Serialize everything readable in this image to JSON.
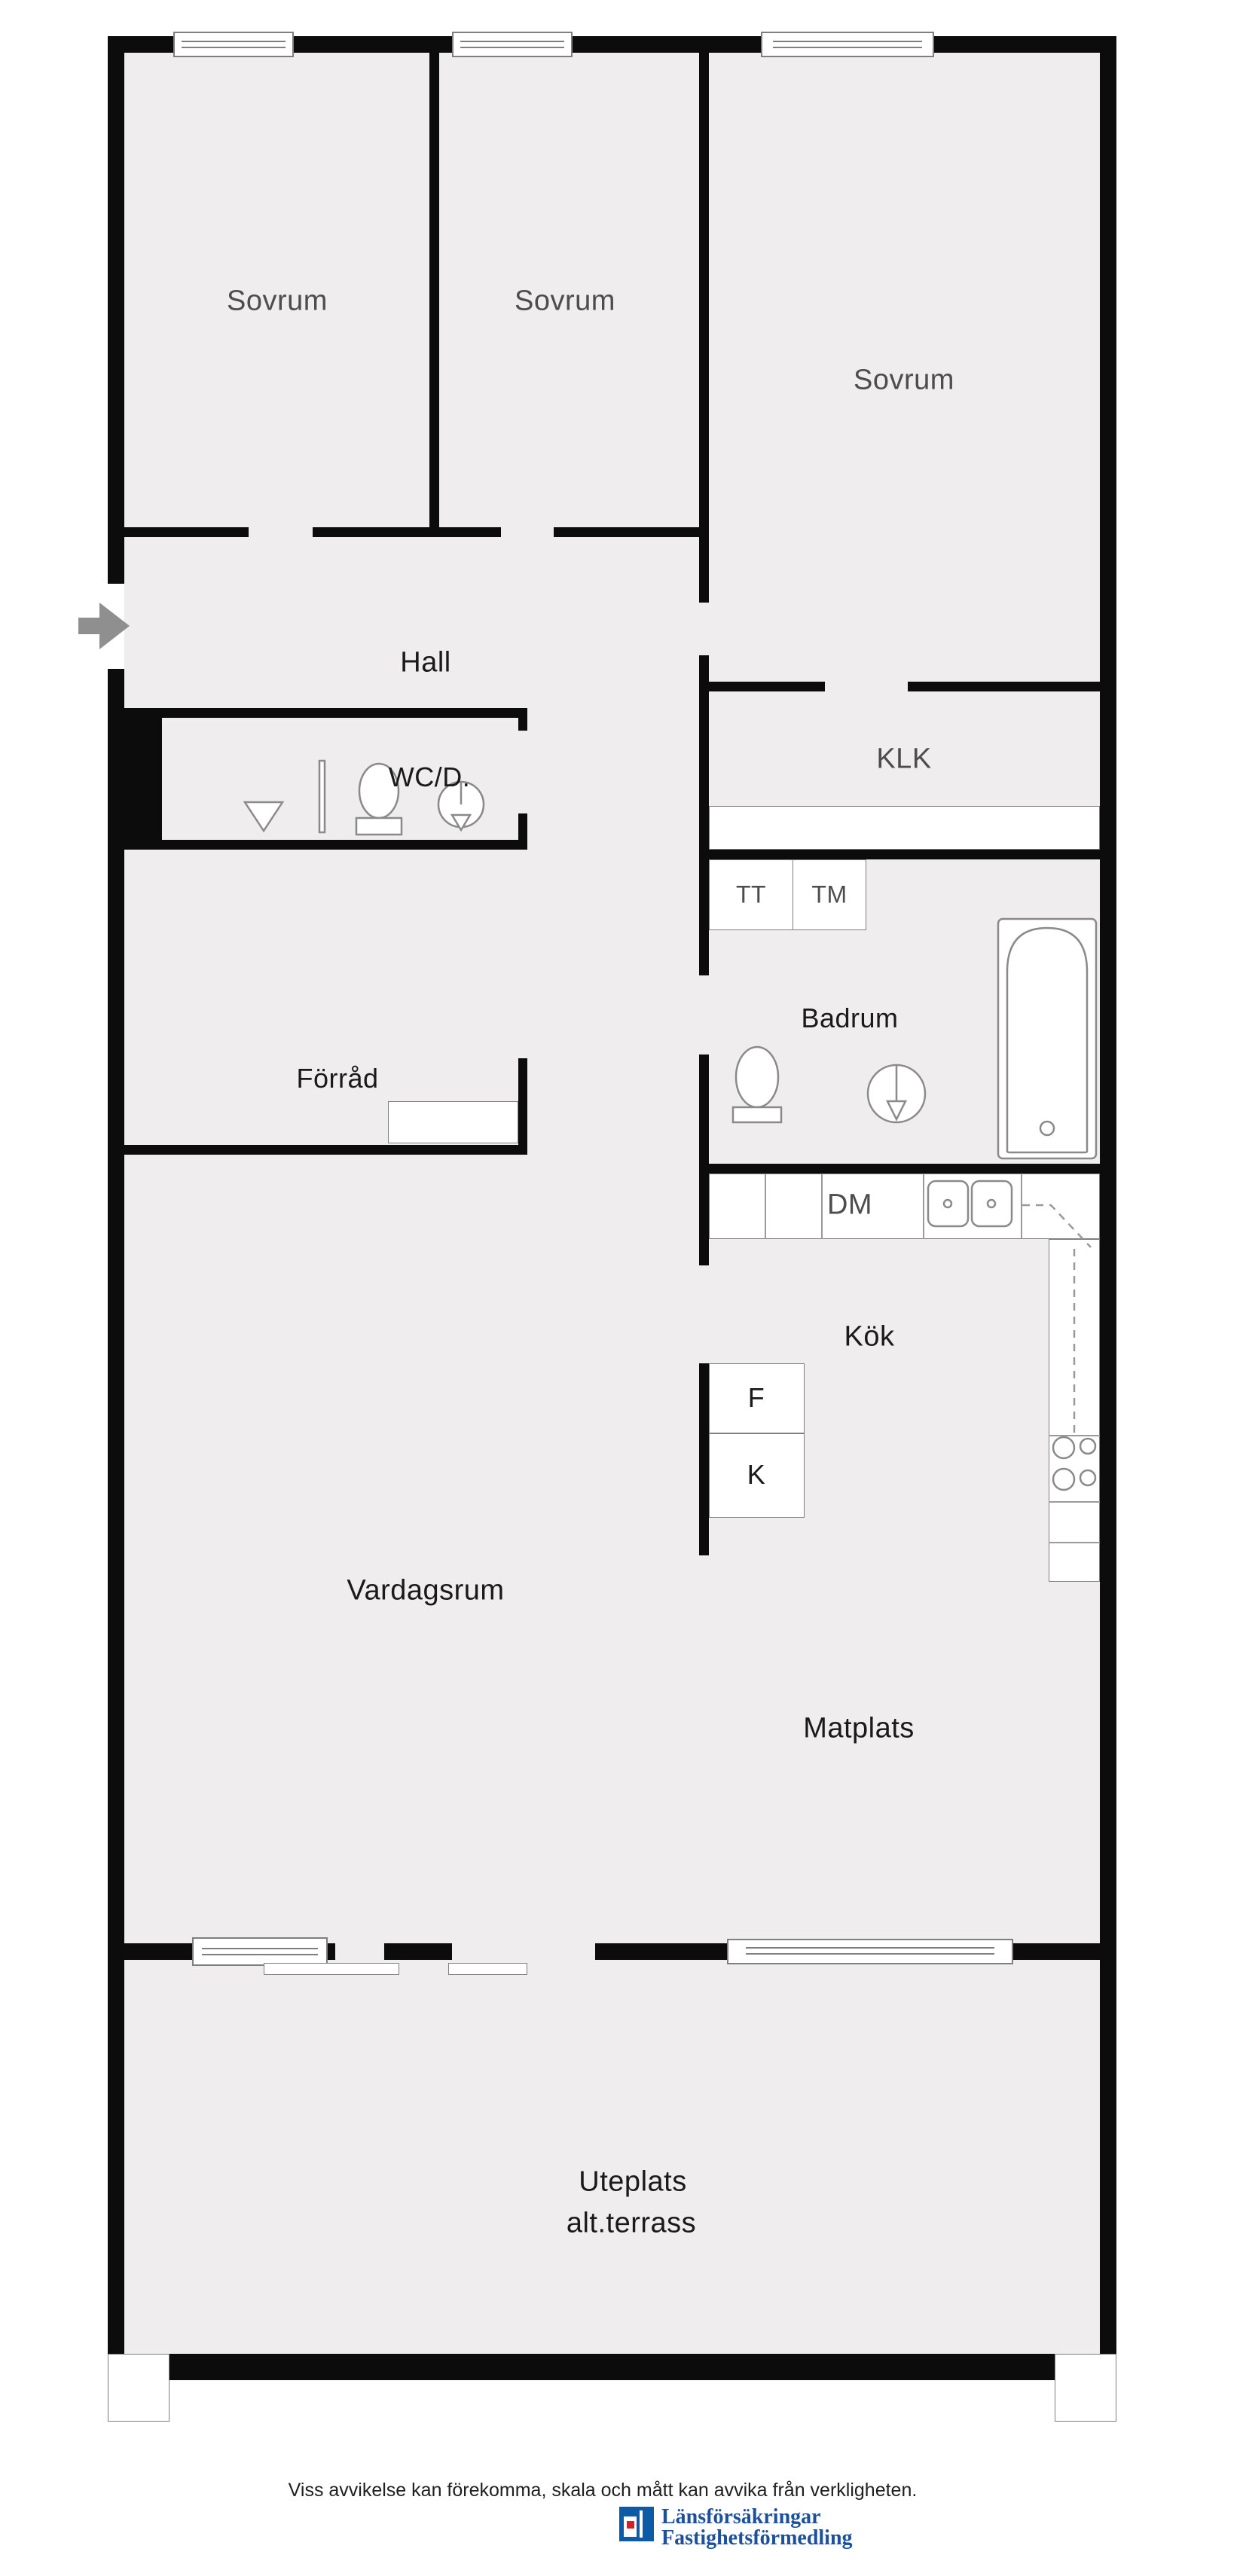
{
  "plan": {
    "rooms": {
      "sovrum1": {
        "label": "Sovrum"
      },
      "sovrum2": {
        "label": "Sovrum"
      },
      "sovrum3": {
        "label": "Sovrum"
      },
      "hall": {
        "label": "Hall"
      },
      "klk": {
        "label": "KLK"
      },
      "wcd": {
        "label": "WC/D."
      },
      "forrad": {
        "label": "Förråd"
      },
      "badrum": {
        "label": "Badrum"
      },
      "kok": {
        "label": "Kök"
      },
      "vardagsrum": {
        "label": "Vardagsrum"
      },
      "matplats": {
        "label": "Matplats"
      },
      "uteplats": {
        "label": "Uteplats",
        "label2": "alt.terrass"
      }
    },
    "appliances": {
      "tt": "TT",
      "tm": "TM",
      "dm": "DM",
      "f": "F",
      "k": "K"
    },
    "icons": [
      "entrance-arrow-icon",
      "window-icon",
      "shower-icon",
      "toilet-icon",
      "washbasin-icon",
      "bathtub-icon",
      "sink-icon",
      "stove-icon"
    ],
    "colors": {
      "floor": "#f0edee",
      "wall": "#0c0c0c",
      "fixture_outline": "#8a8a8a",
      "brand_blue": "#1c4f9e",
      "brand_red": "#d61f26"
    }
  },
  "footer": {
    "disclaimer": "Viss avvikelse kan förekomma, skala och mått kan avvika från verkligheten.",
    "brand_line1": "Länsförsäkringar",
    "brand_line2": "Fastighetsförmedling"
  }
}
